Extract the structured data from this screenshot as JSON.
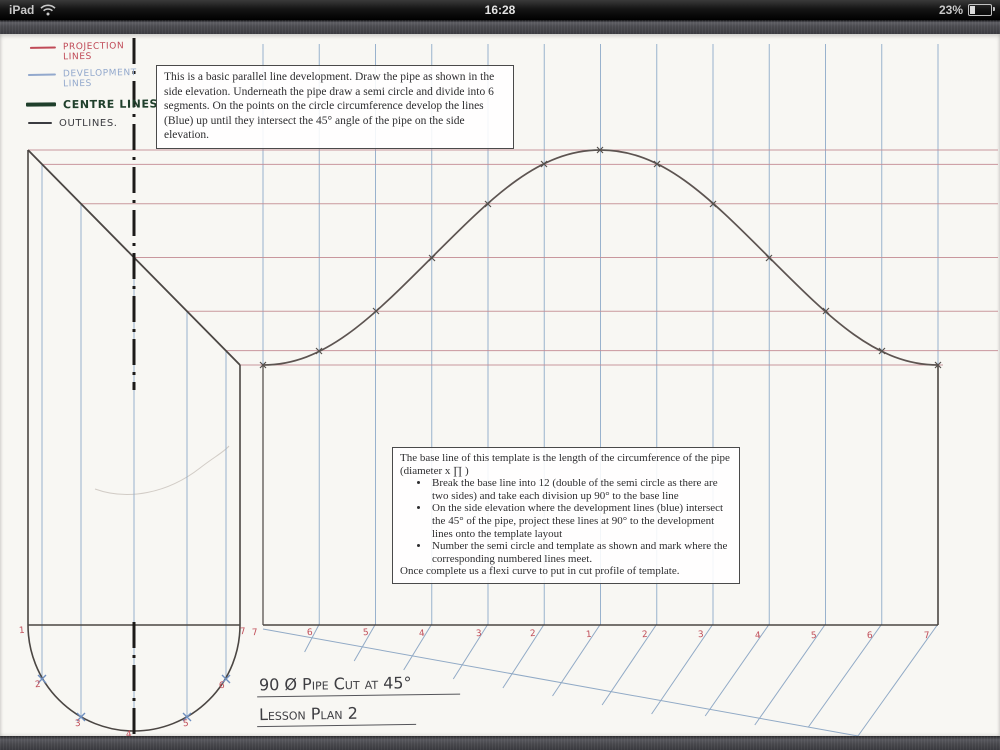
{
  "status_bar": {
    "device": "iPad",
    "time": "16:28",
    "battery_percent": "23%"
  },
  "legend": {
    "items": [
      {
        "label": "Projection Lines",
        "color": "#c04a57"
      },
      {
        "label": "Development Lines",
        "color": "#93a9cd"
      },
      {
        "label": "Centre Lines",
        "color": "#1f3f2b"
      },
      {
        "label": "Outlines.",
        "color": "#3b3b40"
      }
    ]
  },
  "note_top": {
    "text": "This is a basic parallel line development. Draw the pipe as shown in the side elevation. Underneath the pipe draw a semi circle and divide into 6 segments. On the points on the circle circumference develop the lines (Blue) up until they intersect the 45° angle of the pipe on the side elevation."
  },
  "note_template": {
    "intro": "The base line of this template is the length of the circumference of the pipe (diameter x ∏ )",
    "bullets": [
      "Break the base line into 12 (double of the semi circle as there are two sides) and take each division up 90° to the base line",
      "On the side elevation where the development lines (blue) intersect the 45° of the pipe, project these lines at 90° to the development lines onto the template layout",
      "Number the semi circle and template as shown and mark where the corresponding numbered lines meet."
    ],
    "outro": "Once complete us a flexi curve to put in cut profile of template."
  },
  "captions": {
    "title": "90 Ø Pipe Cut at 45°",
    "subtitle": "Lesson Plan 2"
  },
  "semicircle_numbers": [
    "1",
    "2",
    "3",
    "4",
    "5",
    "6",
    "7"
  ],
  "template_numbers": [
    "7",
    "6",
    "5",
    "4",
    "3",
    "2",
    "1",
    "2",
    "3",
    "4",
    "5",
    "6",
    "7"
  ],
  "drawing_colors": {
    "projection": "#c58d94",
    "development": "#8fabc9",
    "centre": "#1c1a18",
    "outline": "#4b4643",
    "curve": "#5d5451",
    "numbers": "#c14f5a"
  }
}
